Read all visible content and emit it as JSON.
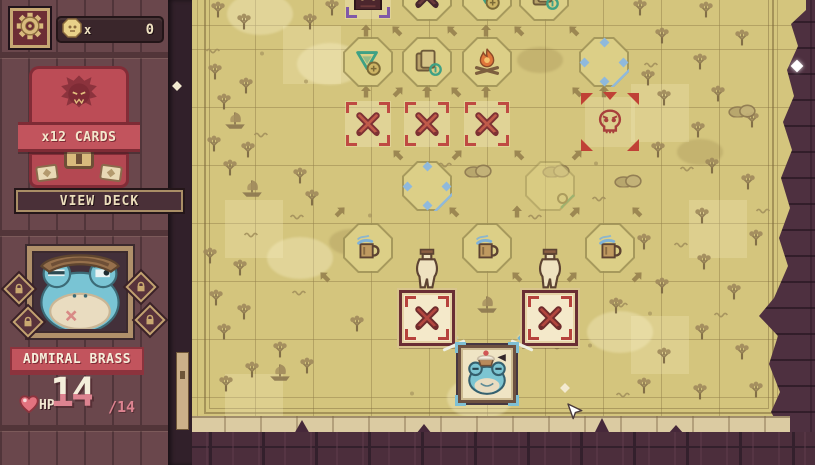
{
  "hud": {
    "settings": {
      "icon": "gear"
    },
    "currency": {
      "icon": "coin",
      "multiplier_label": "x",
      "value": "0"
    },
    "deck": {
      "count_label": "x12 CARDS",
      "view_button_label": "VIEW DECK",
      "emblem_icon": "beast-emblem"
    },
    "character": {
      "name": "ADMIRAL BRASS",
      "portrait_icon": "frog-admiral",
      "trinket_slots": [
        {
          "locked": true
        },
        {
          "locked": true
        },
        {
          "locked": true
        },
        {
          "locked": true
        }
      ],
      "hp_label": "HP",
      "hp_current": "14",
      "hp_max_label": "/14",
      "heart_icon": "heart"
    }
  },
  "colors": {
    "parchment": "#d4c57d",
    "wall": "#4e3040",
    "sidebar_wood": "#6a474c",
    "card_red": "#bc4c56",
    "banner_red": "#c2545d",
    "battle_red": "#b2463f",
    "treasure_blue": "#8fb9dc",
    "shop_green": "#3fa184",
    "gold": "#d9ba7d",
    "hp_pink": "#dd8390",
    "cream": "#f4e8cd",
    "active_tile": "#f4e9ca"
  },
  "map": {
    "nodes": [
      {
        "t": "boss",
        "x": 368,
        "y": -4
      },
      {
        "t": "battle-dark",
        "x": 427,
        "y": -4
      },
      {
        "t": "sell",
        "x": 487,
        "y": -4
      },
      {
        "t": "card-draft",
        "x": 544,
        "y": -4
      },
      {
        "t": "sell",
        "x": 368,
        "y": 62
      },
      {
        "t": "card-draft",
        "x": 427,
        "y": 62
      },
      {
        "t": "campfire",
        "x": 487,
        "y": 62
      },
      {
        "t": "treasure",
        "x": 604,
        "y": 62
      },
      {
        "t": "battle",
        "x": 368,
        "y": 124
      },
      {
        "t": "battle",
        "x": 427,
        "y": 124
      },
      {
        "t": "battle",
        "x": 487,
        "y": 124
      },
      {
        "t": "elite-skull",
        "x": 610,
        "y": 122
      },
      {
        "t": "treasure",
        "x": 427,
        "y": 186
      },
      {
        "t": "reward-gem",
        "x": 550,
        "y": 186
      },
      {
        "t": "tavern-mug",
        "x": 368,
        "y": 248
      },
      {
        "t": "tavern-mug",
        "x": 487,
        "y": 248
      },
      {
        "t": "tavern-mug",
        "x": 610,
        "y": 248
      },
      {
        "t": "jug",
        "x": 427,
        "y": 271
      },
      {
        "t": "jug",
        "x": 550,
        "y": 271
      },
      {
        "t": "battle-active",
        "x": 427,
        "y": 318
      },
      {
        "t": "battle-active",
        "x": 550,
        "y": 318
      }
    ],
    "player": {
      "token": "frog-captain",
      "x": 487,
      "y": 374
    },
    "arrows": [
      {
        "d": "up",
        "x": 366,
        "y": 31
      },
      {
        "d": "nw",
        "x": 397,
        "y": 31
      },
      {
        "d": "nw",
        "x": 452,
        "y": 31
      },
      {
        "d": "up",
        "x": 486,
        "y": 31
      },
      {
        "d": "nw",
        "x": 519,
        "y": 31
      },
      {
        "d": "nw",
        "x": 574,
        "y": 31
      },
      {
        "d": "up",
        "x": 366,
        "y": 92
      },
      {
        "d": "ne",
        "x": 398,
        "y": 92
      },
      {
        "d": "up",
        "x": 427,
        "y": 92
      },
      {
        "d": "nw",
        "x": 456,
        "y": 92
      },
      {
        "d": "up",
        "x": 486,
        "y": 92
      },
      {
        "d": "nw",
        "x": 577,
        "y": 92
      },
      {
        "d": "up",
        "x": 604,
        "y": 92
      },
      {
        "d": "nw",
        "x": 398,
        "y": 155
      },
      {
        "d": "ne",
        "x": 457,
        "y": 155
      },
      {
        "d": "nw",
        "x": 519,
        "y": 155
      },
      {
        "d": "ne",
        "x": 577,
        "y": 155
      },
      {
        "d": "ne",
        "x": 340,
        "y": 212
      },
      {
        "d": "nw",
        "x": 454,
        "y": 212
      },
      {
        "d": "up",
        "x": 517,
        "y": 212
      },
      {
        "d": "ne",
        "x": 575,
        "y": 212
      },
      {
        "d": "nw",
        "x": 637,
        "y": 212
      },
      {
        "d": "nw",
        "x": 325,
        "y": 277
      },
      {
        "d": "nw",
        "x": 517,
        "y": 277
      },
      {
        "d": "ne",
        "x": 572,
        "y": 277
      },
      {
        "d": "ne",
        "x": 637,
        "y": 277
      }
    ],
    "path_arrows": [
      {
        "d": "nw",
        "x": 452,
        "y": 336
      },
      {
        "d": "ne",
        "x": 523,
        "y": 336
      }
    ],
    "decorations": {
      "tree": [
        [
          218,
          12
        ],
        [
          244,
          24
        ],
        [
          310,
          24
        ],
        [
          332,
          10
        ],
        [
          215,
          74
        ],
        [
          246,
          88
        ],
        [
          224,
          104
        ],
        [
          214,
          146
        ],
        [
          248,
          152
        ],
        [
          230,
          170
        ],
        [
          300,
          178
        ],
        [
          312,
          200
        ],
        [
          210,
          258
        ],
        [
          240,
          270
        ],
        [
          216,
          300
        ],
        [
          244,
          314
        ],
        [
          224,
          334
        ],
        [
          280,
          352
        ],
        [
          307,
          368
        ],
        [
          252,
          372
        ],
        [
          226,
          386
        ],
        [
          357,
          326
        ],
        [
          640,
          10
        ],
        [
          706,
          12
        ],
        [
          662,
          38
        ],
        [
          742,
          40
        ],
        [
          700,
          64
        ],
        [
          648,
          80
        ],
        [
          718,
          96
        ],
        [
          664,
          100
        ],
        [
          752,
          122
        ],
        [
          698,
          132
        ],
        [
          658,
          152
        ],
        [
          712,
          168
        ],
        [
          748,
          184
        ],
        [
          702,
          218
        ],
        [
          644,
          244
        ],
        [
          756,
          240
        ],
        [
          704,
          264
        ],
        [
          662,
          288
        ],
        [
          734,
          294
        ],
        [
          616,
          308
        ],
        [
          702,
          334
        ],
        [
          664,
          358
        ],
        [
          742,
          354
        ],
        [
          644,
          388
        ],
        [
          700,
          394
        ],
        [
          756,
          392
        ]
      ],
      "ship": [
        [
          235,
          122
        ],
        [
          252,
          190
        ],
        [
          280,
          374
        ],
        [
          487,
          306
        ]
      ],
      "rock": [
        [
          556,
          172
        ],
        [
          628,
          182
        ],
        [
          742,
          112
        ],
        [
          478,
          172
        ]
      ],
      "squig": [
        [
          214,
          48
        ],
        [
          262,
          132
        ],
        [
          298,
          214
        ],
        [
          252,
          232
        ],
        [
          536,
          214
        ],
        [
          600,
          196
        ],
        [
          622,
          302
        ],
        [
          682,
          242
        ],
        [
          722,
          312
        ],
        [
          652,
          62
        ],
        [
          300,
          290
        ],
        [
          558,
          344
        ],
        [
          624,
          392
        ],
        [
          446,
          162
        ],
        [
          764,
          208
        ],
        [
          688,
          166
        ]
      ],
      "dot": [
        [
          262,
          50
        ],
        [
          306,
          78
        ],
        [
          596,
          160
        ],
        [
          650,
          310
        ],
        [
          370,
          212
        ],
        [
          590,
          342
        ],
        [
          412,
          390
        ]
      ],
      "sparkle_white": [
        [
          797,
          66
        ]
      ],
      "sparkle_cream": [
        [
          565,
          388
        ],
        [
          177,
          86
        ]
      ],
      "stain_light": [
        [
          330,
          64
        ],
        [
          300,
          258
        ],
        [
          620,
          332
        ],
        [
          480,
          398
        ],
        [
          260,
          14
        ]
      ],
      "stain_dark": [
        [
          352,
          242
        ],
        [
          700,
          152
        ],
        [
          540,
          60
        ]
      ],
      "tile_light": [
        [
          283,
          26
        ],
        [
          225,
          200
        ],
        [
          631,
          84
        ],
        [
          689,
          200
        ],
        [
          631,
          316
        ],
        [
          225,
          374
        ]
      ]
    },
    "cursor": {
      "x": 566,
      "y": 402
    }
  }
}
